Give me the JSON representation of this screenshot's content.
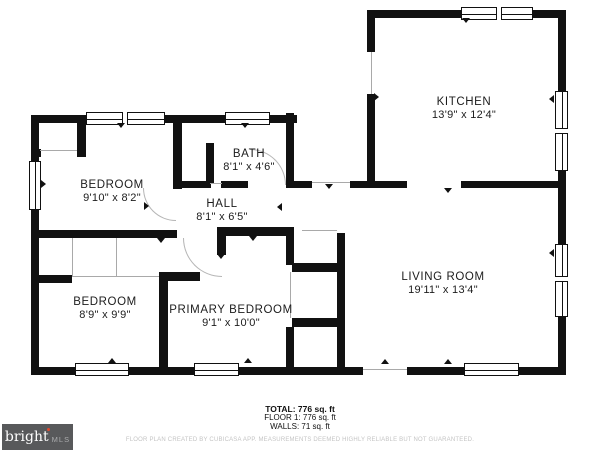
{
  "plan": {
    "wall_color": "#111111",
    "rooms": [
      {
        "id": "kitchen",
        "name": "KITCHEN",
        "dims": "13'9\" x 12'4\"",
        "cx": 464,
        "cy": 96
      },
      {
        "id": "bath",
        "name": "BATH",
        "dims": "8'1\" x 4'6\"",
        "cx": 249,
        "cy": 148
      },
      {
        "id": "hall",
        "name": "HALL",
        "dims": "8'1\" x 6'5\"",
        "cx": 222,
        "cy": 198
      },
      {
        "id": "bedroom-1",
        "name": "BEDROOM",
        "dims": "9'10\" x 8'2\"",
        "cx": 112,
        "cy": 179
      },
      {
        "id": "bedroom-2",
        "name": "BEDROOM",
        "dims": "8'9\" x 9'9\"",
        "cx": 105,
        "cy": 296
      },
      {
        "id": "primary-bedroom",
        "name": "PRIMARY BEDROOM",
        "dims": "9'1\" x 10'0\"",
        "cx": 231,
        "cy": 304
      },
      {
        "id": "living-room",
        "name": "LIVING ROOM",
        "dims": "19'11\" x 13'4\"",
        "cx": 443,
        "cy": 271
      }
    ],
    "walls": [
      [
        367,
        10,
        199,
        8
      ],
      [
        558,
        10,
        8,
        365
      ],
      [
        367,
        10,
        8,
        42
      ],
      [
        367,
        94,
        8,
        94
      ],
      [
        31,
        115,
        266,
        8
      ],
      [
        31,
        115,
        8,
        260
      ],
      [
        31,
        367,
        332,
        8
      ],
      [
        407,
        367,
        159,
        8
      ],
      [
        173,
        115,
        9,
        74
      ],
      [
        206,
        143,
        8,
        41
      ],
      [
        173,
        181,
        38,
        7
      ],
      [
        221,
        181,
        27,
        7
      ],
      [
        286,
        113,
        8,
        75
      ],
      [
        286,
        181,
        26,
        7
      ],
      [
        350,
        181,
        57,
        7
      ],
      [
        461,
        181,
        105,
        7
      ],
      [
        31,
        230,
        146,
        8
      ],
      [
        217,
        227,
        77,
        9
      ],
      [
        217,
        227,
        9,
        28
      ],
      [
        286,
        230,
        8,
        35
      ],
      [
        292,
        263,
        45,
        9
      ],
      [
        292,
        318,
        45,
        9
      ],
      [
        286,
        327,
        8,
        48
      ],
      [
        337,
        233,
        8,
        142
      ],
      [
        159,
        272,
        9,
        103
      ],
      [
        159,
        272,
        41,
        9
      ],
      [
        31,
        275,
        41,
        8
      ],
      [
        77,
        122,
        9,
        35
      ],
      [
        31,
        149,
        10,
        8
      ]
    ],
    "windows": [
      {
        "x": 86,
        "y": 112,
        "w": 79,
        "h": 13,
        "o": "h",
        "cross": 0.47
      },
      {
        "x": 225,
        "y": 112,
        "w": 45,
        "h": 13,
        "o": "h"
      },
      {
        "x": 461,
        "y": 7,
        "w": 72,
        "h": 13,
        "o": "h",
        "cross": 0.5
      },
      {
        "x": 29,
        "y": 161,
        "w": 12,
        "h": 49,
        "o": "v"
      },
      {
        "x": 555,
        "y": 91,
        "w": 13,
        "h": 80,
        "o": "v",
        "cross": 0.47
      },
      {
        "x": 555,
        "y": 244,
        "w": 13,
        "h": 73,
        "o": "v",
        "cross": 0.45
      },
      {
        "x": 75,
        "y": 363,
        "w": 54,
        "h": 13,
        "o": "h"
      },
      {
        "x": 194,
        "y": 363,
        "w": 45,
        "h": 13,
        "o": "h"
      },
      {
        "x": 464,
        "y": 363,
        "w": 55,
        "h": 13,
        "o": "h"
      }
    ],
    "door_lines": [
      [
        371,
        52,
        1,
        42
      ],
      [
        312,
        182,
        38,
        1
      ],
      [
        363,
        369,
        44,
        1
      ],
      [
        302,
        230,
        35,
        1
      ],
      [
        72,
        276,
        87,
        1
      ],
      [
        72,
        238,
        1,
        38
      ],
      [
        116,
        238,
        1,
        39
      ],
      [
        40,
        150,
        37,
        1
      ],
      [
        210,
        183,
        12,
        1
      ],
      [
        290,
        272,
        1,
        46
      ]
    ],
    "door_arcs": [
      {
        "x": 250,
        "y": 149,
        "s": 36,
        "corner": "tr"
      },
      {
        "x": 183,
        "y": 238,
        "s": 39,
        "corner": "bl"
      },
      {
        "x": 143,
        "y": 188,
        "s": 33,
        "corner": "bl"
      }
    ],
    "markers": [
      {
        "x": 117,
        "y": 123,
        "dir": "down"
      },
      {
        "x": 241,
        "y": 123,
        "dir": "down"
      },
      {
        "x": 462,
        "y": 18,
        "dir": "down"
      },
      {
        "x": 41,
        "y": 180,
        "dir": "right"
      },
      {
        "x": 549,
        "y": 95,
        "dir": "left"
      },
      {
        "x": 549,
        "y": 249,
        "dir": "left"
      },
      {
        "x": 108,
        "y": 358,
        "dir": "up"
      },
      {
        "x": 244,
        "y": 358,
        "dir": "up"
      },
      {
        "x": 444,
        "y": 359,
        "dir": "up"
      },
      {
        "x": 381,
        "y": 359,
        "dir": "up"
      },
      {
        "x": 444,
        "y": 188,
        "dir": "down"
      },
      {
        "x": 157,
        "y": 238,
        "dir": "down"
      },
      {
        "x": 217,
        "y": 254,
        "dir": "down"
      },
      {
        "x": 249,
        "y": 236,
        "dir": "down"
      },
      {
        "x": 325,
        "y": 184,
        "dir": "down"
      },
      {
        "x": 144,
        "y": 202,
        "dir": "right"
      },
      {
        "x": 277,
        "y": 203,
        "dir": "left"
      },
      {
        "x": 374,
        "y": 93,
        "dir": "right"
      }
    ]
  },
  "footer": {
    "total": "TOTAL: 776 sq. ft",
    "floor": "FLOOR 1: 776 sq. ft",
    "walls": "WALLS: 71 sq. ft",
    "disclaimer": "FLOOR PLAN CREATED BY CUBICASA APP. MEASUREMENTS DEEMED HIGHLY RELIABLE BUT NOT GUARANTEED."
  },
  "logo": {
    "brand": "bright",
    "suffix": "MLS",
    "background": "#58595b",
    "accent": "#e0492e"
  }
}
